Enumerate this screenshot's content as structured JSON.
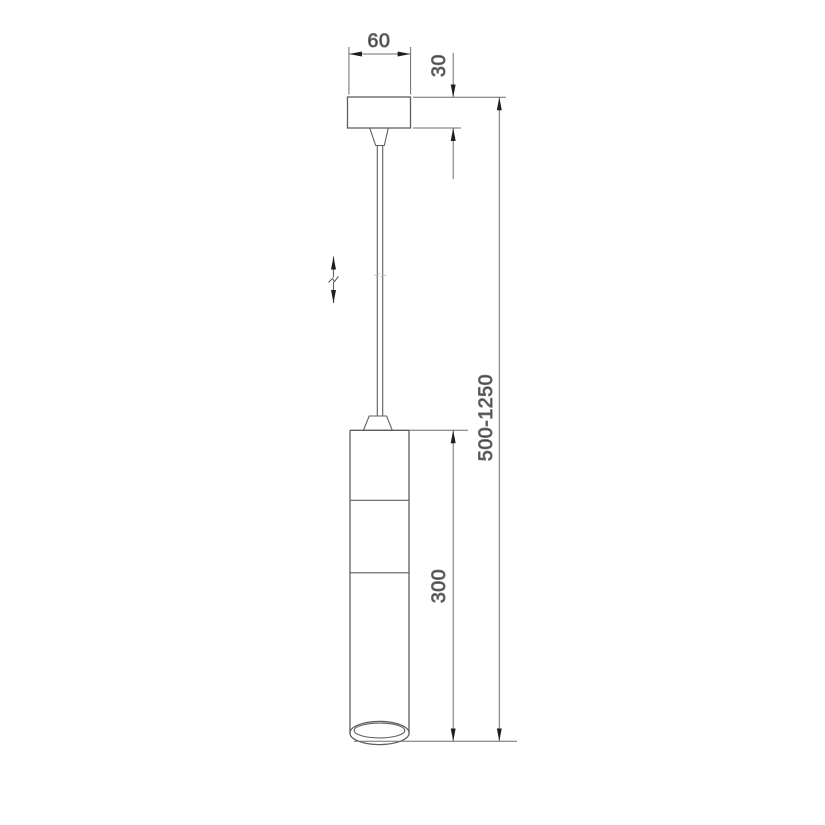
{
  "drawing": {
    "description": "Technical dimension drawing of a cylindrical pendant ceiling lamp on adjustable cable suspension",
    "labels": {
      "canopy_width_mm": "60",
      "canopy_height_mm": "30",
      "lamp_body_height_mm": "300",
      "suspension_height_range_mm": "500-1250"
    },
    "colors": {
      "background": "#ffffff",
      "object_line": "#5f5f5f",
      "dimension_line": "#6e6e6e",
      "arrow": "#1f1f1f",
      "text": "#3a3a3a"
    }
  }
}
